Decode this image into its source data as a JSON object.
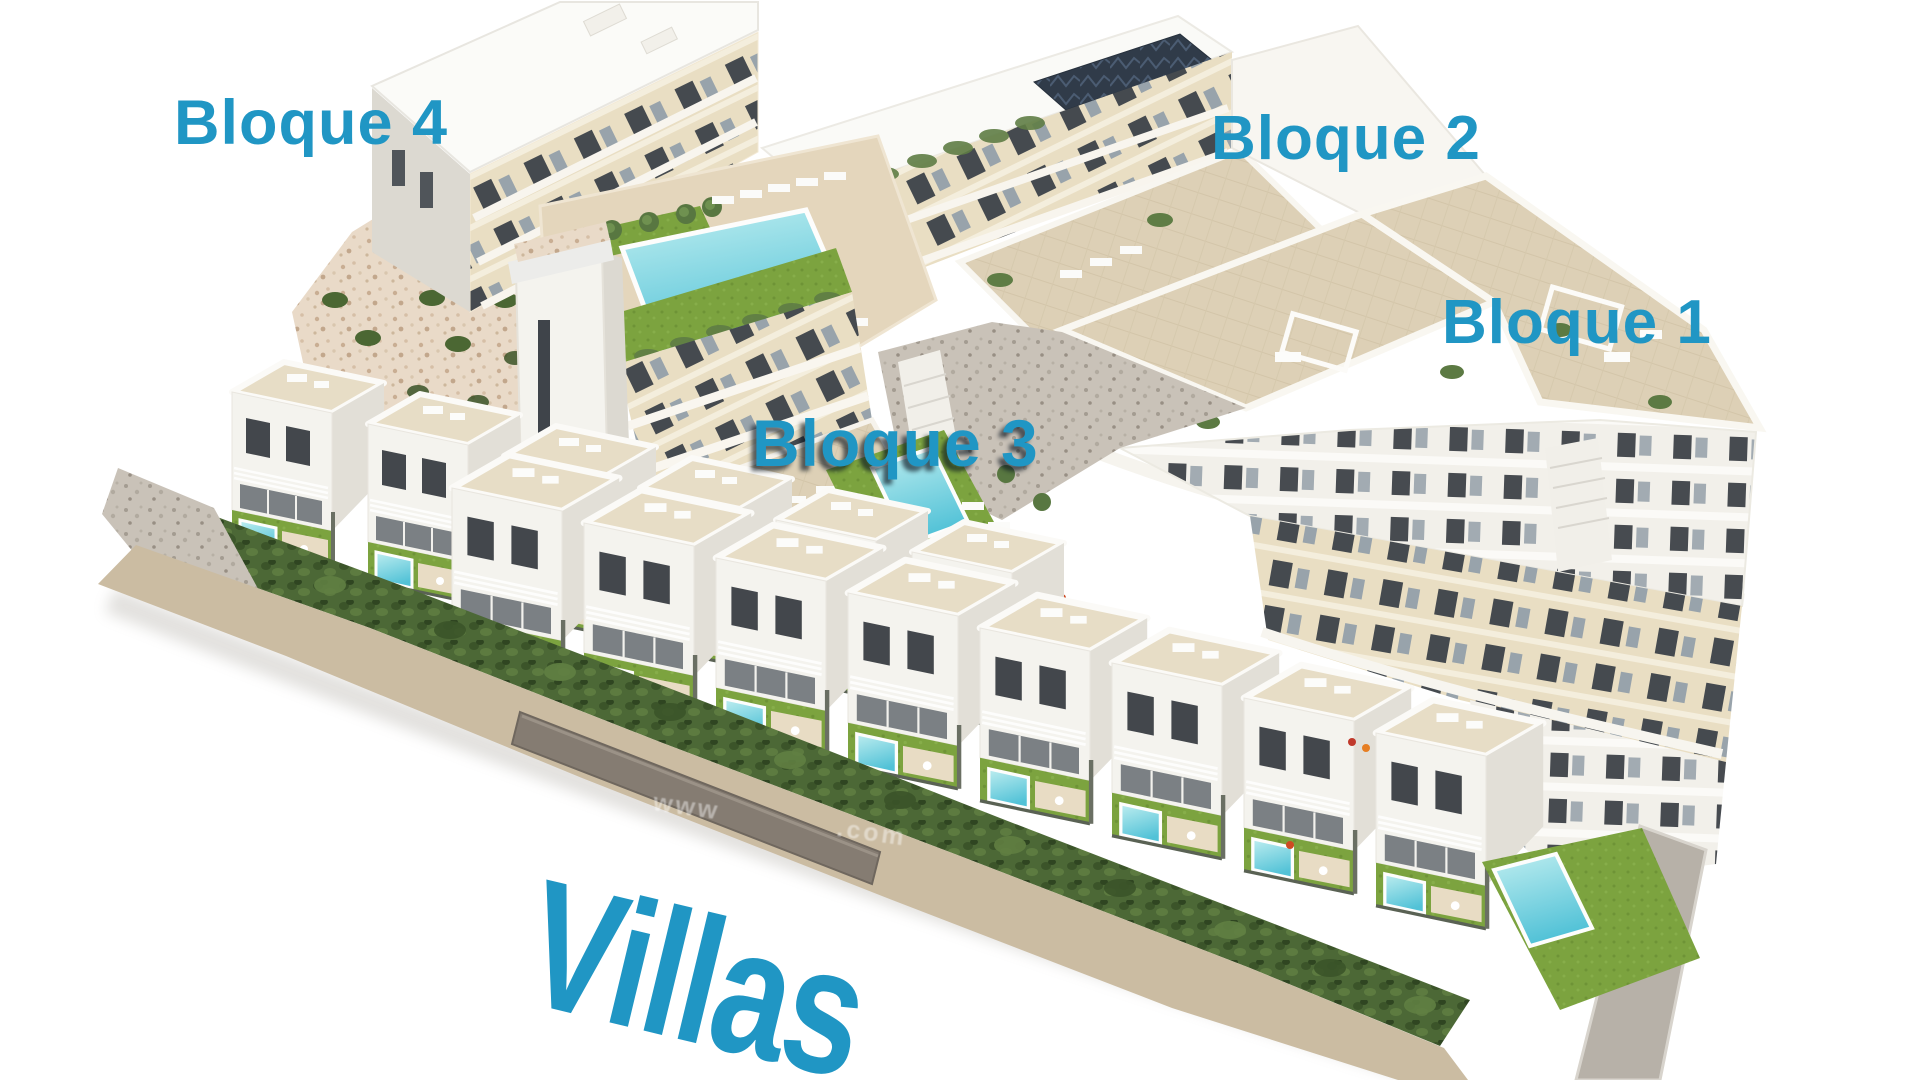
{
  "scene": {
    "description": "Aerial 3D render of a Mediterranean residential development: four cream apartment blocks around a communal pool, a staircase tower, and two rows of white villas with private pools behind a long conifer hedge",
    "background_color": "#ffffff"
  },
  "labels": {
    "block4": "Bloque 4",
    "block2": "Bloque 2",
    "block1": "Bloque 1",
    "block3": "Bloque 3",
    "villas": "Villas",
    "color": "#2096c4"
  },
  "watermark": {
    "fragment_left": "www",
    "fragment_right": ".com"
  },
  "palette": {
    "facade_cream": "#e9dec3",
    "facade_white": "#f4f3ee",
    "roof_deck": "#ddd0b6",
    "pool_water": "#52c2d7",
    "lawn": "#7ca33f",
    "hedge": "#4c6836",
    "rock": "#e9dac8",
    "road": "#cbbca2"
  }
}
